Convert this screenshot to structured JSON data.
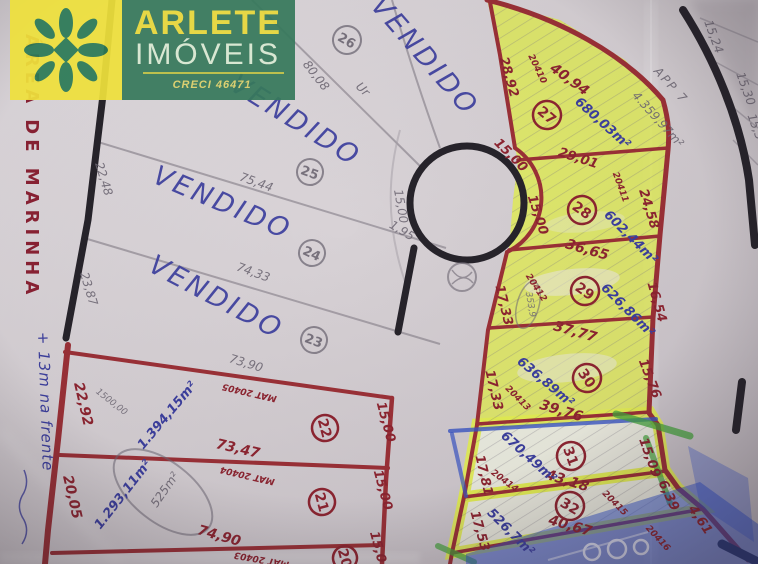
{
  "logo": {
    "brand_line1": "ARLETE",
    "brand_line2": "IMÓVEIS",
    "creci": "CRECI 46471"
  },
  "map": {
    "marinha_label": "ÁREA DE MARINHA",
    "left_note": "+ 13m na frente",
    "vendido": "VENDIDO",
    "app": {
      "label": "APP 7",
      "area": "4.359,97m²"
    },
    "pencil": {
      "p8008": "80,08",
      "ur": "Ur",
      "p7544": "75,44",
      "p7433": "74,33",
      "p7390": "73,90",
      "p2248": "22,48",
      "p2387": "23,87",
      "p1500": "15,00",
      "p195": "1,95",
      "p1500v": "1500,00",
      "p525": "525m²",
      "p3539": "353,9",
      "p1524": "15,24",
      "p1530": "15,30",
      "p153": "15,3"
    }
  },
  "lots": {
    "l20": {
      "num": "20",
      "mat": "MAT 20403",
      "road": "15,0"
    },
    "l21": {
      "num": "21",
      "mat": "MAT 20404",
      "area": "1.293,11m²",
      "left": "20,05",
      "top": "73,47",
      "bottom": "74,90",
      "road": "15,00"
    },
    "l22": {
      "num": "22",
      "mat": "MAT 20405",
      "area": "1.394,15m²",
      "left": "22,92",
      "road": "15,00"
    },
    "l23": {
      "num": "23"
    },
    "l24": {
      "num": "24"
    },
    "l25": {
      "num": "25"
    },
    "l26": {
      "num": "26"
    },
    "l27": {
      "num": "27",
      "mat": "20410",
      "area": "680,03m²",
      "left": "28,92",
      "top": "40,94",
      "road": "15,00",
      "bottom": "29,01"
    },
    "l28": {
      "num": "28",
      "mat": "20411",
      "area": "602,44m²",
      "road": "15,00",
      "right": "24,58",
      "bottom": "36,65"
    },
    "l29": {
      "num": "29",
      "mat": "20412",
      "area": "626,86m²",
      "road": "17,33",
      "right": "16,54",
      "bottom": "37,77"
    },
    "l30": {
      "num": "30",
      "mat": "20413",
      "area": "636,89m²",
      "road": "17,33",
      "right": "15,76",
      "bottom": "39,76"
    },
    "l31": {
      "num": "31",
      "mat": "20414",
      "area": "670,49m²",
      "road": "17,81",
      "right": "15,09",
      "bottom": "43,18"
    },
    "l32": {
      "num": "32",
      "mat": "20415",
      "area": "526,7m²",
      "road": "17,53",
      "right": "6,39",
      "corner": "4,61",
      "bottom": "40,67"
    },
    "l33": {
      "mat": "20416"
    }
  },
  "colors": {
    "brand_green": "#37795c",
    "brand_yellow": "#efe13c",
    "pen_red": "#9c3036",
    "ink_blue": "#3c3f9f",
    "highlight_yellow": "#e6f152",
    "marker_green": "#44a53c",
    "crayon_blue": "#2e4fd0",
    "pencil_gray": "#75707a"
  }
}
